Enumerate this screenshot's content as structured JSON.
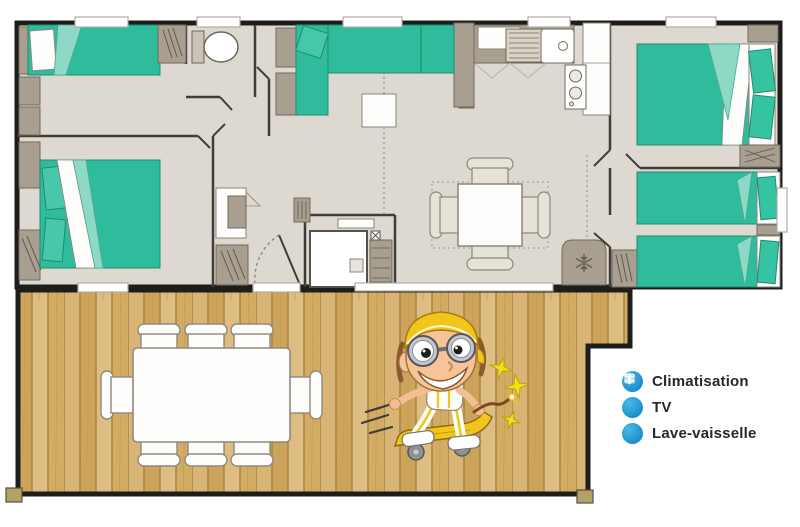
{
  "legend": {
    "items": [
      {
        "icon": "snowflake-icon",
        "label": "Climatisation"
      },
      {
        "icon": "tv-icon",
        "label": "TV"
      },
      {
        "icon": "dishwasher-icon",
        "label": "Lave-vaisselle"
      }
    ],
    "icon_blue_top": "#49b9e9",
    "icon_blue_bottom": "#1b8cca",
    "text_color": "#26282c"
  },
  "floorplan": {
    "colors": {
      "outer_wall": "#1d1d1b",
      "interior_wall": "#3f3d3a",
      "floor": "#ded9d0",
      "furniture_taupe": "#a89f90",
      "bed_green": "#2fbc9c",
      "bed_green_light": "#8ed9c5",
      "deck_wood": "#d5af6b",
      "deck_wood_dark": "#a67f3f",
      "mascot_yellow": "#f2c51c"
    }
  }
}
